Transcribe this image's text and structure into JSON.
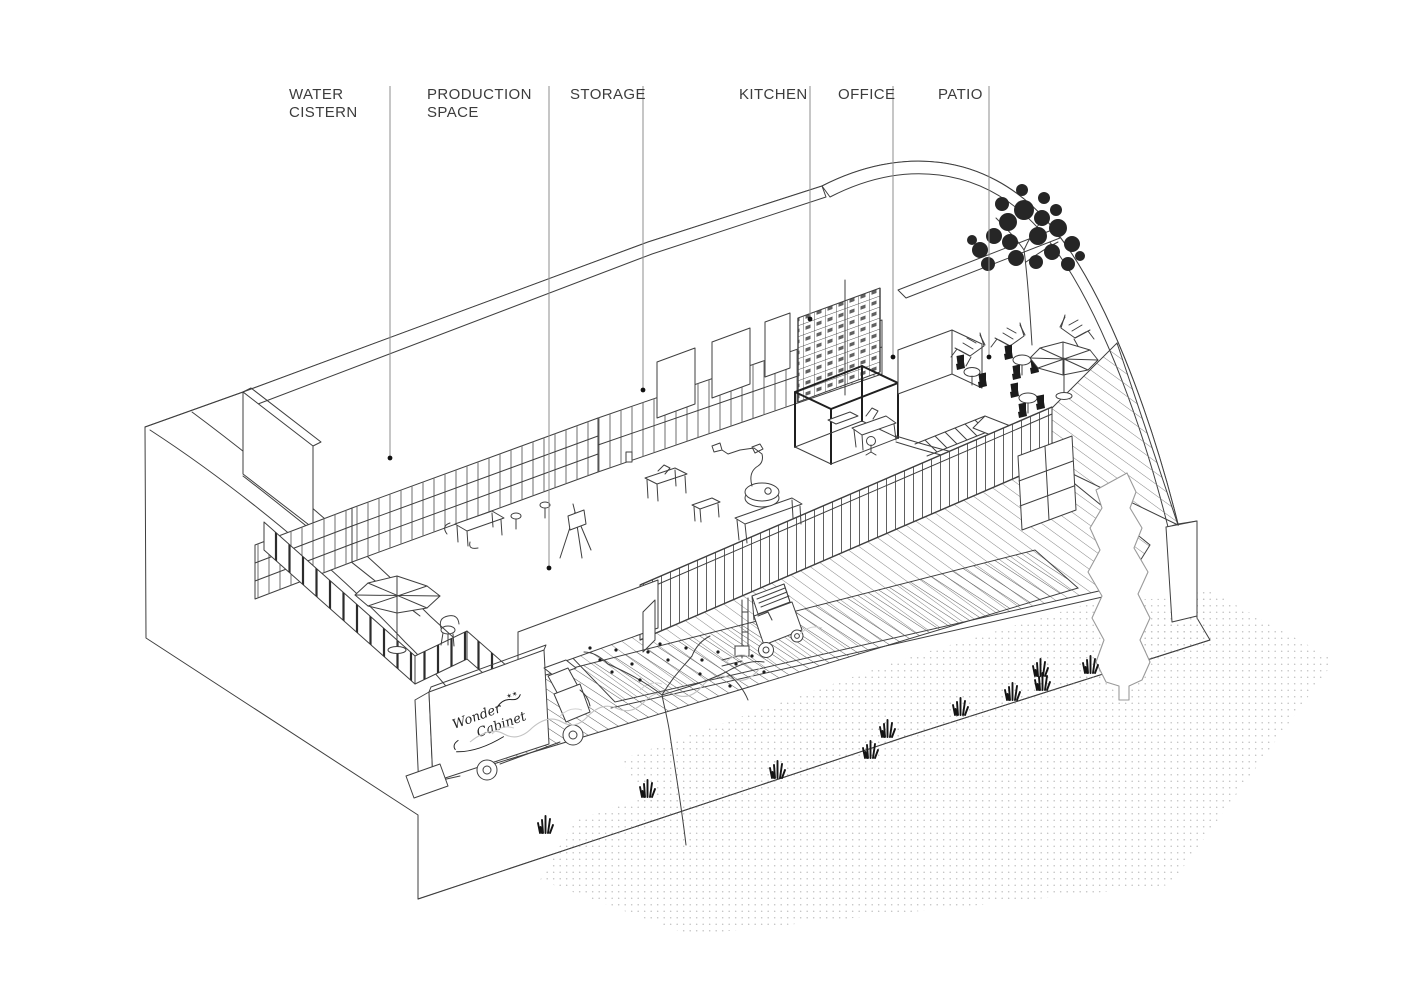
{
  "drawing_title": "axonometric building diagram",
  "labels": [
    {
      "id": "water-cistern",
      "line1": "WATER",
      "line2": "CISTERN"
    },
    {
      "id": "production-space",
      "line1": "PRODUCTION",
      "line2": "SPACE"
    },
    {
      "id": "storage",
      "line1": "STORAGE",
      "line2": ""
    },
    {
      "id": "kitchen",
      "line1": "KITCHEN",
      "line2": ""
    },
    {
      "id": "office",
      "line1": "OFFICE",
      "line2": ""
    },
    {
      "id": "patio",
      "line1": "PATIO",
      "line2": ""
    }
  ],
  "truck": {
    "line1": "Wonder",
    "line2": "Cabinet",
    "stars": "✶✶"
  },
  "colors": {
    "ink": "#3f3f3f",
    "leader": "#8c8c8c",
    "label_text": "#3c3c3c",
    "paper": "#ffffff",
    "foliage": "#1c1c1c"
  }
}
